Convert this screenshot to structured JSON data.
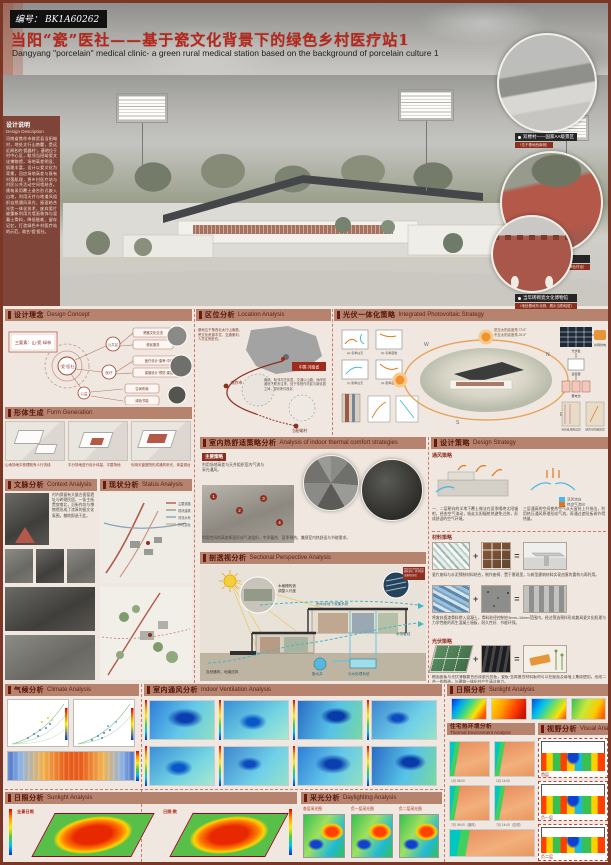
{
  "accents": {
    "frame": "#7b3626",
    "bar_bg": "#b5836e",
    "bar_text": "#54120a",
    "title_red": "#b3271c",
    "cool_flow": "#49b8e5",
    "warm_flow": "#e07820"
  },
  "header": {
    "code_label": "编号：",
    "code": "BK1A60262",
    "title_cn": "当阳“瓷”医社——基于瓷文化背景下的绿色乡村医疗站1",
    "subtitle_en": "Dangyang \"porcelain\" medical clinic- a green rural medical station based on the background of porcelain culture 1"
  },
  "description": {
    "title_cn": "设计说明",
    "title_en": "Design Description",
    "body": "河南省焦作市修武县当阳峪村，地处太行山南麓，是远近闻名的“瓷器村”。基地位于村中心区，毗邻当阳峪瓷文化博物馆，场地高差明显、肌理丰富。设计以瓷文化为背景，回应场地高差与既有村落肌理，将乡村医疗站与村民公共活动空间相结合。建筑采用覆土退台形式嵌入山地，利用天井与地道风组织自然通风采光；屋面结合光伏一体化技术，废弃瓷片被重新利用为墙面装饰与混凝土骨料，降低能耗、留存记忆，打造绿色乡村医疗站的示范，故名“瓷”医社。"
  },
  "hero_callouts": [
    {
      "label": "双楼村——国家AA级景区",
      "sub": "（位于基地西南侧）"
    },
    {
      "label": "村中道路",
      "sub": "（瓷片、瓷渣铺就的红褐色村径）"
    },
    {
      "label": "当年砖砌瓷文化博物馆",
      "sub": "（地处基地东北侧，展示当阳峪窑）"
    }
  ],
  "sections": {
    "concept": {
      "cn": "设计理念",
      "en": "Design Concept"
    },
    "location": {
      "cn": "区位分析",
      "en": "Location Analysis"
    },
    "pv": {
      "cn": "光伏一体化策略",
      "en": "Integrated Photovoltaic Strategy"
    },
    "form": {
      "cn": "形体生成",
      "en": "Form Generation"
    },
    "context": {
      "cn": "文脉分析",
      "en": "Context Analysis"
    },
    "status": {
      "cn": "现状分析",
      "en": "Status Analysis"
    },
    "comfort": {
      "cn": "室内热舒适策略分析",
      "en": "Analysis of indoor thermal comfort strategies"
    },
    "strategy": {
      "cn": "设计策略",
      "en": "Design Strategy"
    },
    "sectional": {
      "cn": "剖透视分析",
      "en": "Sectional Perspective Analysis"
    },
    "climate": {
      "cn": "气候分析",
      "en": "Climate Analysis"
    },
    "ventilation": {
      "cn": "室内通风分析",
      "en": "Indoor Ventilation Analysis"
    },
    "sunlight": {
      "cn": "日照分析",
      "en": "Sunlight Analysis"
    },
    "thermal_env": {
      "cn": "住宅热环境分析",
      "en": "Thermal Environment Analysis"
    },
    "visual": {
      "cn": "视野分析",
      "en": "Visual Analysis"
    },
    "sunlight_bottom": {
      "cn": "日照分析",
      "en": "Sunlight Analysis"
    },
    "daylight": {
      "cn": "采光分析",
      "en": "Daylighting Analysis"
    }
  },
  "concept": {
    "keybox": "三要素：山·瓷·绿林",
    "root": "“瓷”医社",
    "nodes": [
      "公共区",
      "医疗",
      "公益"
    ],
    "leaves": [
      "瓷器文化交流",
      "便民服务",
      "医疗设计·康养·中医",
      "保健设计·预防·康复",
      "空间布局",
      "绿色节能"
    ]
  },
  "location": {
    "note": "基地位于豫西北太行山南麓，瓷文化资源丰富，交通便利，人员往来密切。",
    "country": "中国·河南省",
    "city": "焦作市",
    "village": "当阳峪村",
    "desc": "南依、毗邻村庄民居，交通以山路、休闲河滩地下联系往来，处于传统作坊区与新民居之间，现状条件良好。"
  },
  "pv": {
    "sun_summer": "夏至太阳高度角 73.5°",
    "sun_winter": "冬至太阳高度角 26.5°",
    "compass_w": "W",
    "compass_n": "N",
    "compass_s": "S",
    "compass_e": "E",
    "flow1": "光伏板",
    "flow2": "逆变器",
    "flow3": "蓄电池",
    "flow4": "并网供电",
    "room_captions": [
      "(a) 冬季白天",
      "(b) 冬季夜晚",
      "(c) 夏季白天",
      "(d) 夏季夜晚"
    ],
    "wall_cap1": "光伏幕墙构造层",
    "wall_cap2": "通风空腔散热层"
  },
  "form": {
    "captions": [
      "山地场地中梳理既有人行流线",
      "平分场地进行设计体量，平整场地",
      "利用天窗庭院形成通风采光，体量退台"
    ]
  },
  "context_text": "村内保留有大量古瓷窑遗址与砖砌民居，一条主街贯穿南北，沿街作坊与博物馆形成了浓厚的瓷文化氛围，基地即选于此。",
  "status_legend": [
    "主要道路",
    "现状建筑",
    "河流水系",
    "作坊遗址"
  ],
  "comfort": {
    "tag": "主要策略",
    "note": "利用场地高差与天井组织室内气流与采光通风。",
    "bottom": "利用空间的高差断面形成气流组织，冬季蓄热、夏季排热，兼顾室内热舒适与节能需求。"
  },
  "strategy": {
    "sub1": "通风策略",
    "legend_cool": "凉风流向",
    "legend_warm": "热空气流向",
    "cap1": "一、二层朝向的半地下覆土做法在夏季隔绝太阳辐射，经由空气流动，吸走太阳辐射热避免过热，形成舒适的空气环境。",
    "cap2": "三层通高的空间使热空气从天窗处上升排出，利用热压通风原理形成气流，再通过遮阳板调节得热量。",
    "sub2": "材料策略",
    "mat_cap1": "瓷片废料与水泥预制材料结合，制作座椅、置于景观里，与新型建筑材料实现创意的重构与再利用。",
    "mat_cap2": "将废弃瓷渣骨料掺入混凝土，骨料粒径控制在5mm–10mm范围内，经过筛选预拌形成兼具瓷文化肌理与力学性能的再生混凝土墙板，耐久性好、节能环保。",
    "sub3": "光伏策略",
    "mat_cap3": "釉面瓷板与光伏薄膜复合形成瓷光伏板，瓷板·金属复合材料板材可以在屋面及幕墙上集成使用，形成二合一的构造，与建筑一体化并产生清洁电力。"
  },
  "sectional": {
    "grille1": "木格栅构造",
    "grille2": "调整人尺度",
    "rain": "雨水经地下收集系统",
    "well": "集水井",
    "sewage": "污水处理系统",
    "vent": "自然通风，地道送风",
    "pipes": "水流管线",
    "panel_note": "屋面光伏板吸收太阳辐射发电，多余热量由通风层带走"
  },
  "thermal_captions": [
    "1月 08:00",
    "1月 14:00",
    "7月 08:00（通风）",
    "7月 14:00（空调）"
  ],
  "visual_labels": [
    "首层",
    "负一层",
    "负二层"
  ],
  "sunlight_bottom_labels": {
    "left": "全景日照",
    "mid": "日照·数"
  },
  "daylight_labels": [
    "各层采光图",
    "负一层采光图",
    "负二层采光图"
  ]
}
